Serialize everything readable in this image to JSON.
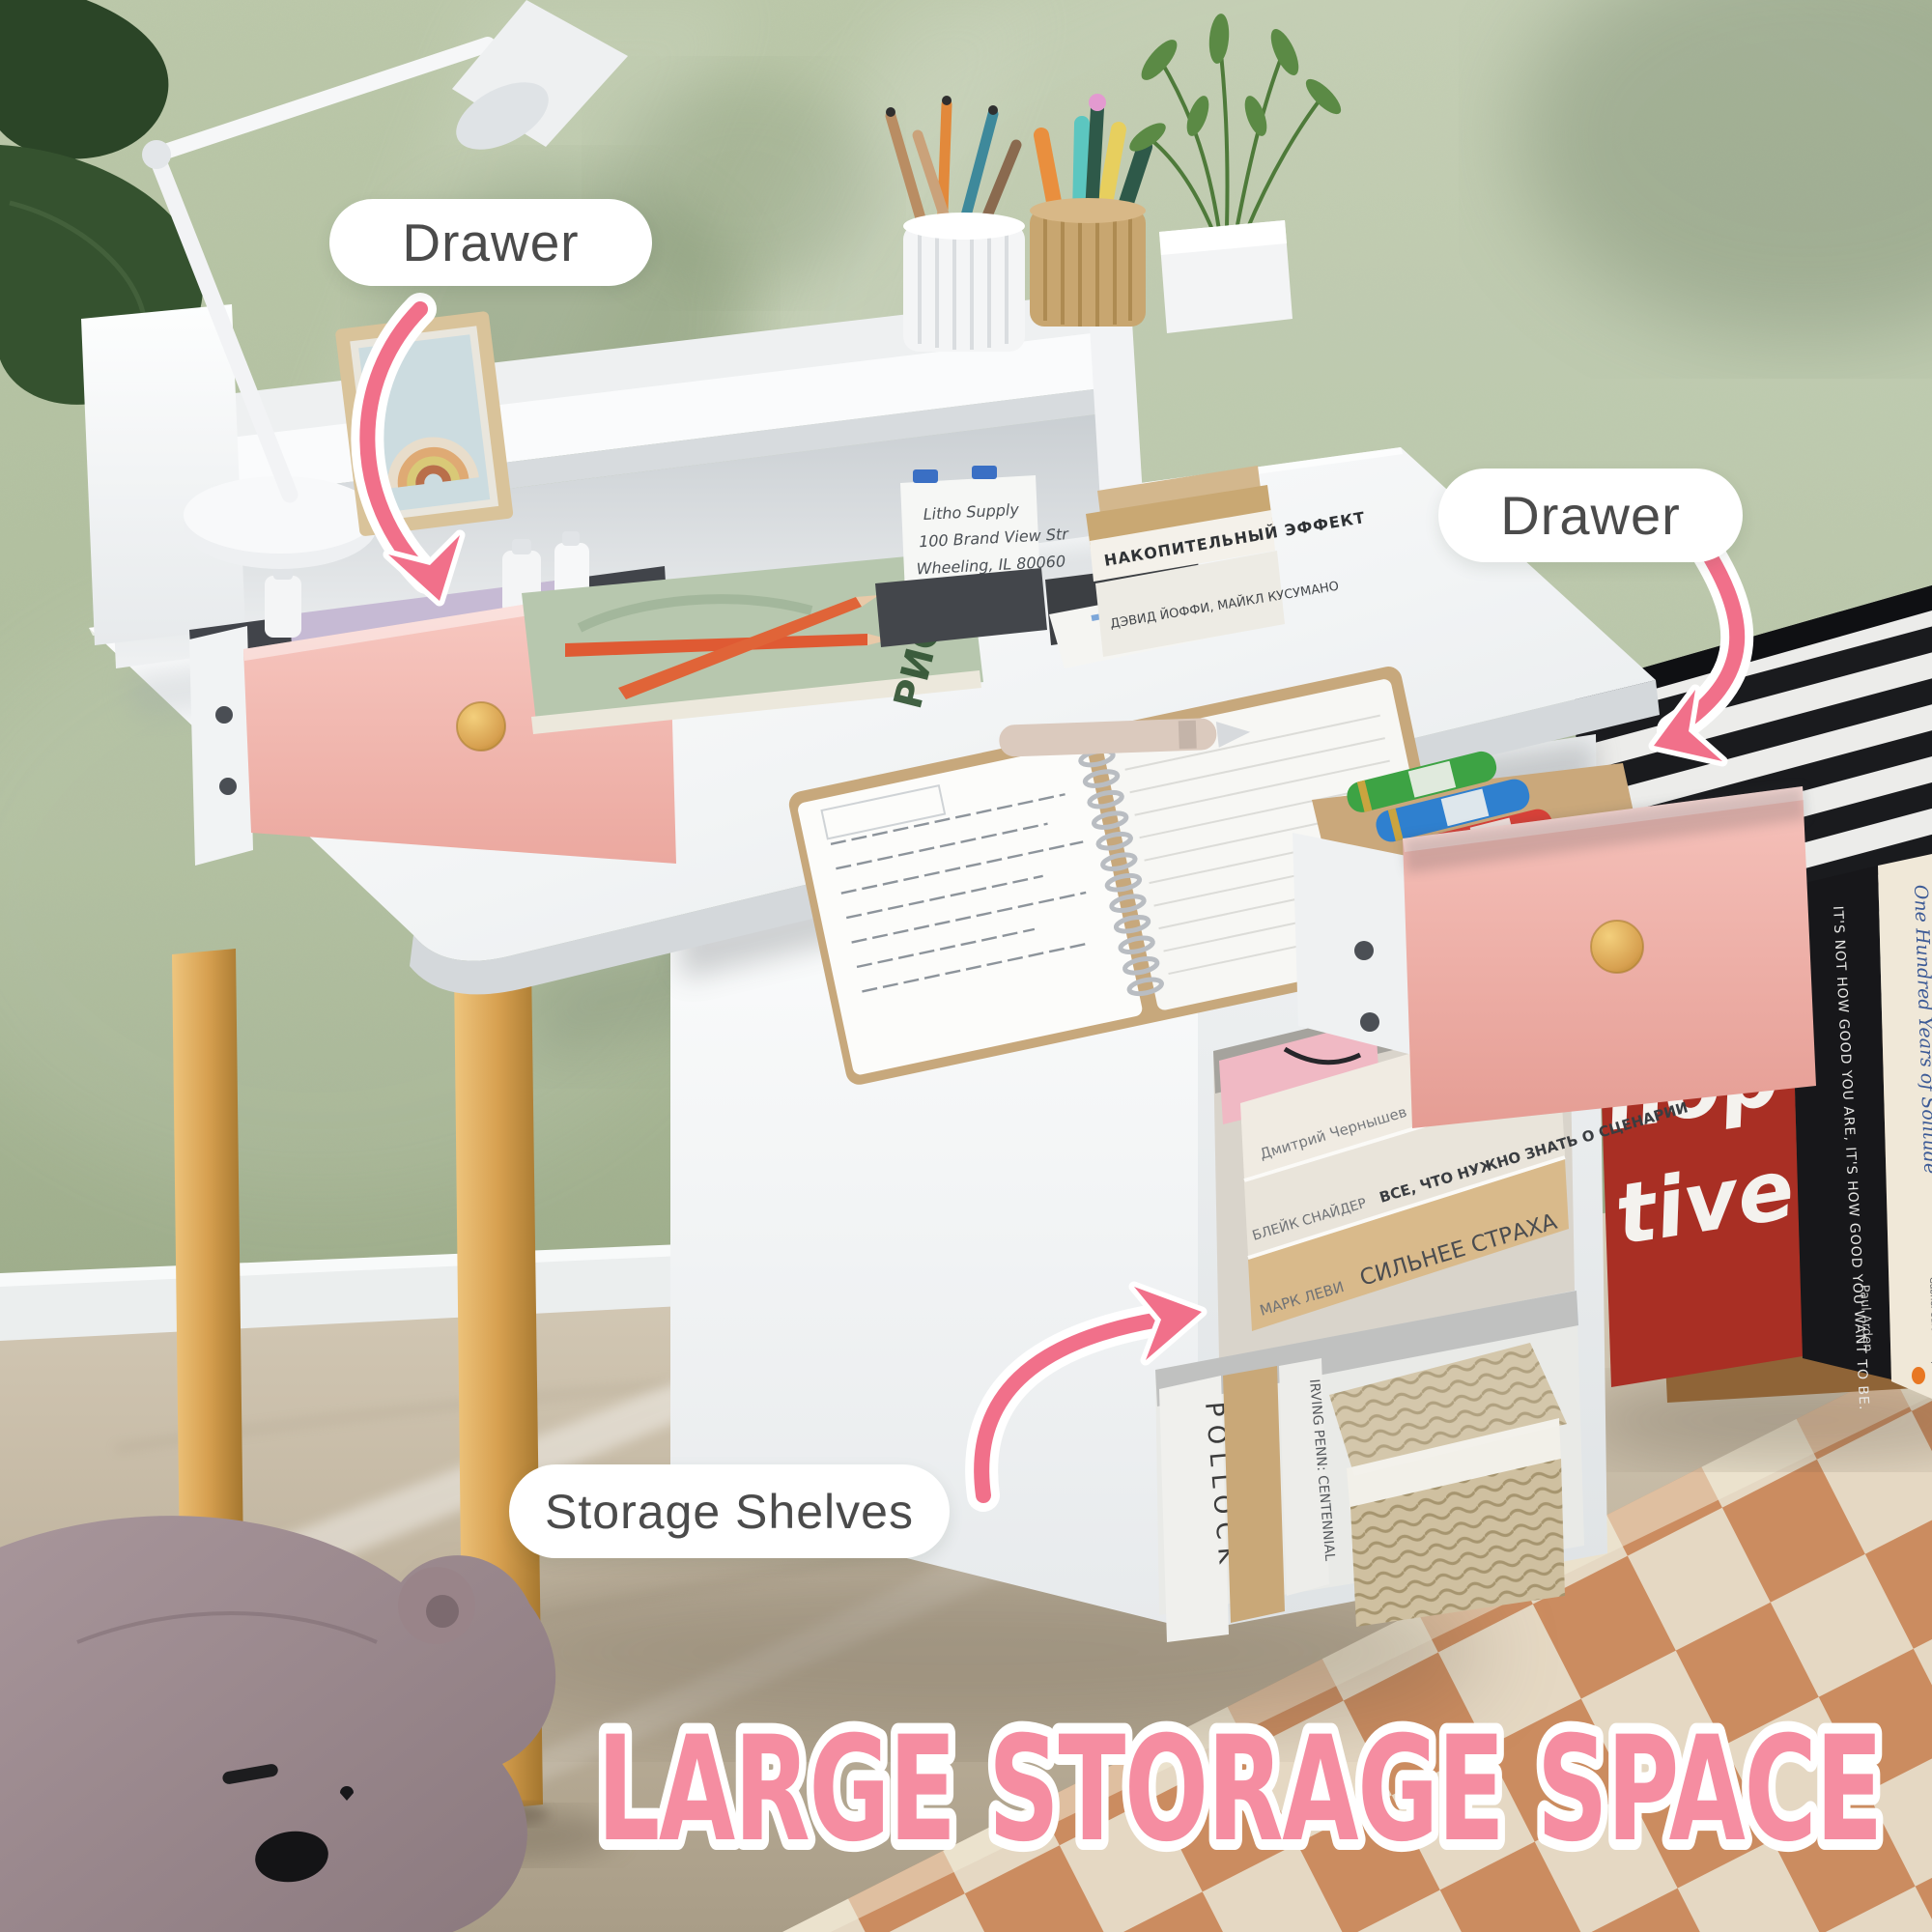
{
  "labels": {
    "drawer_left": "Drawer",
    "drawer_right": "Drawer",
    "storage_shelves": "Storage Shelves"
  },
  "title": "LARGE STORAGE SPACE",
  "colors": {
    "accent_pink": "#f1708a",
    "title_pink": "#f58da1",
    "drawer_pink": "#f2b5b0",
    "wall_green": "#afbe9d",
    "wood": "#d7a050",
    "label_text": "#4b4b4b"
  },
  "desk": {
    "card_lines": [
      "Litho Supply",
      "100 Brand View Str",
      "Wheeling, IL 80060"
    ]
  },
  "books": {
    "green_spine": "РИСУНКА",
    "desk_stack": {
      "top_title": "НАКОПИТЕЛЬНЫЙ ЭФФЕКТ",
      "top_author": "Марк Гоулстон",
      "bottom_title": "ДЭВИД ЙОФФИ, МАЙКЛ КУСУМАНО"
    },
    "shelf": [
      {
        "author": "Дмитрий Чернышев",
        "title": "КАК ЛЮДИ ДУМАЮТ"
      },
      {
        "author": "БЛЕЙК СНАЙДЕР",
        "title": "ВСЕ, ЧТО НУЖНО ЗНАТЬ О СЦЕНАРИИ"
      },
      {
        "author": "МАРК ЛЕВИ",
        "title": "СИЛЬНЕЕ СТРАХА"
      }
    ],
    "vertical": [
      "POLLOCK",
      "IRVING PENN: CENTENNIAL"
    ],
    "side": {
      "need": "NEED",
      "big1": "hop",
      "big2": "tive",
      "arden_title": "IT'S NOT HOW GOOD YOU ARE, IT'S HOW GOOD YOU WANT TO BE.",
      "arden_author": "Paul Arden",
      "solitude_title": "One Hundred Years of Solitude",
      "solitude_author": "Gabriel García Márquez"
    }
  }
}
